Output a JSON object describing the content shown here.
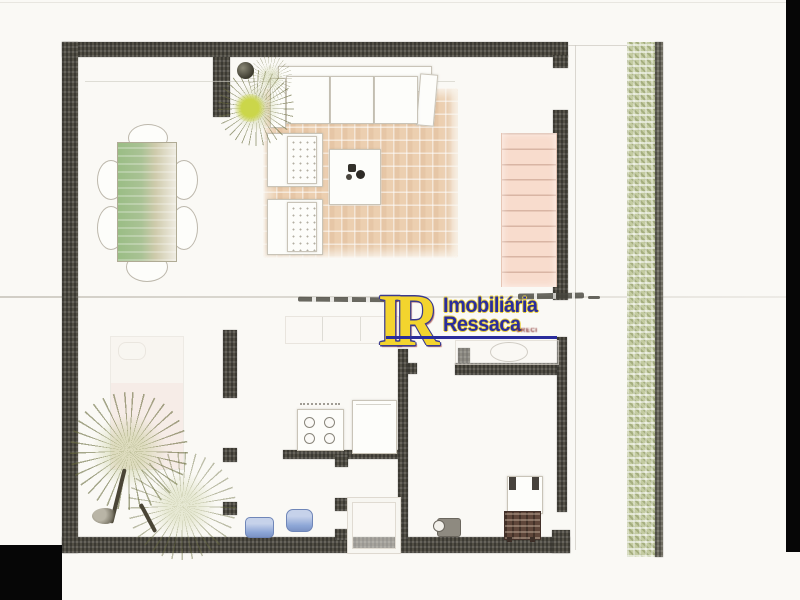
{
  "document": {
    "kind": "scanned real-estate floor plan",
    "levels": [
      "upper level: dining area, living room, staircase, side hedge",
      "ground level: bedroom with palms, kitchen, bathrooms, utility room"
    ]
  },
  "watermark": {
    "initials": "IR",
    "name_line1": "Imobiliária",
    "name_line2": "Ressaca",
    "creci": "CRECI",
    "colors": {
      "initials_fill": "#f3d42e",
      "initials_outline": "#3a3a8e",
      "name_fill": "#2a2d9c",
      "name_outline": "#e8cf3f",
      "underline": "#2a2d9c",
      "creci_text": "#7c1d1d"
    }
  },
  "palette": {
    "page_background": "#faf9f5",
    "wall": "#524f45",
    "wall_light": "#6e6c60",
    "rug": "#eccfb0",
    "stairs": "#f8dccd",
    "stair_line": "#d9b5a4",
    "hedge_green": "#c3cba1",
    "hedge_edge": "#6e6c60",
    "dining_table_green": "#9abd85",
    "dining_table_tan": "#efece2",
    "fixture_blue": "#8da6d6",
    "grill_brown": "#5f463a",
    "scan_black": "#060606"
  },
  "elements": {
    "upper_level": [
      "dining-table",
      "dining-chair x6",
      "area-rug",
      "sofa",
      "armchair x2",
      "coffee-table",
      "potted-plant",
      "staircase",
      "hedge-strip"
    ],
    "ground_level": [
      "bed",
      "palm-plant x2",
      "wardrobe",
      "stove",
      "kitchen-counter",
      "shower",
      "washbasin",
      "bidet",
      "bathroom-counter",
      "water-heater",
      "grill"
    ]
  }
}
